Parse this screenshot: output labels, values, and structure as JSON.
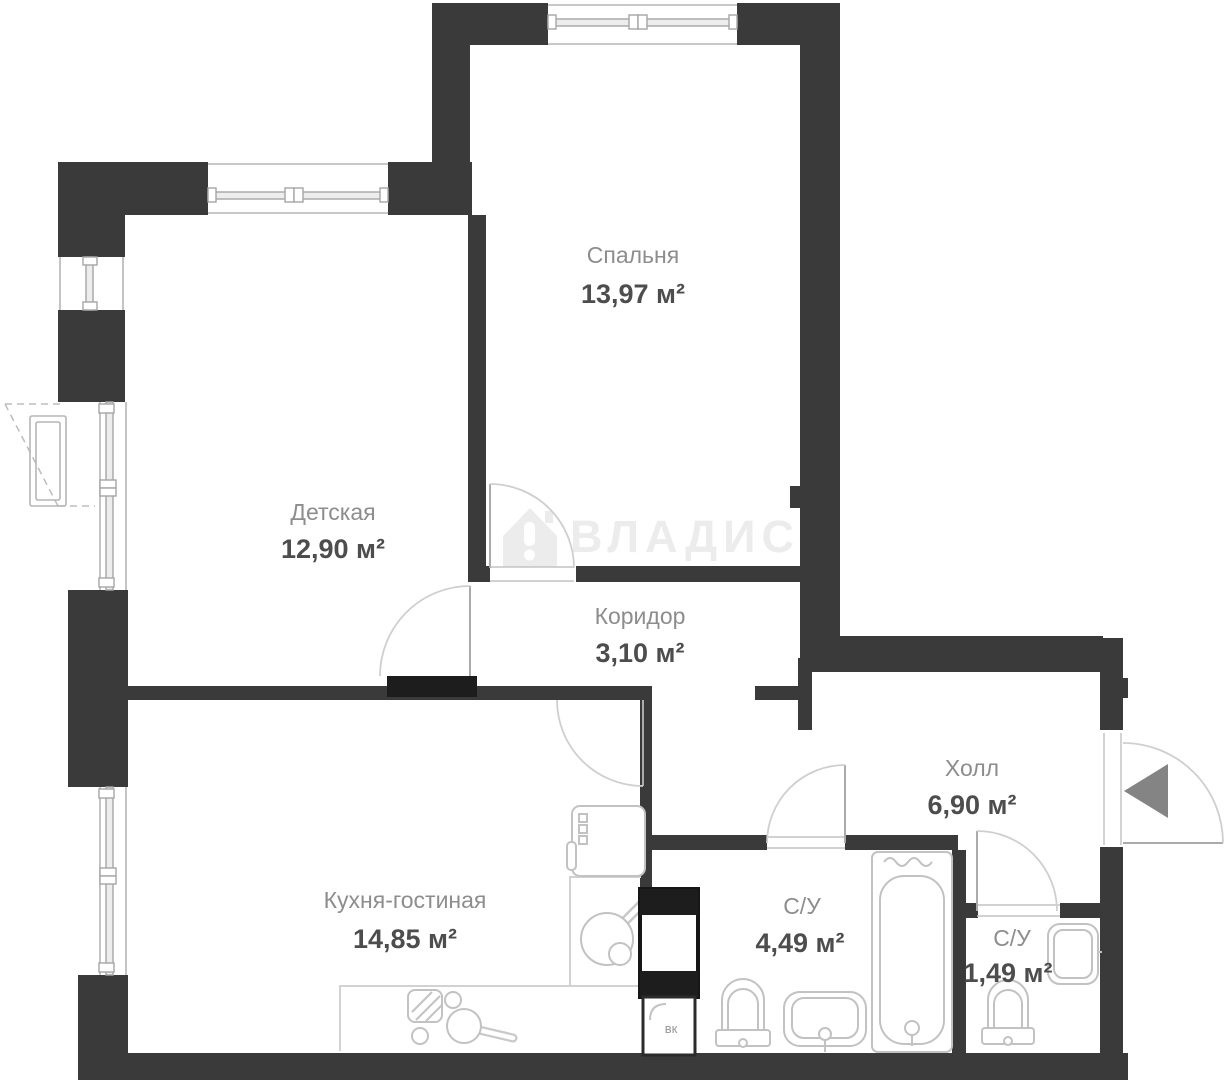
{
  "watermark": {
    "text": "ВЛАДИС"
  },
  "rooms": [
    {
      "name": "Спальня",
      "area": "13,97 м²"
    },
    {
      "name": "Детская",
      "area": "12,90 м²"
    },
    {
      "name": "Коридор",
      "area": "3,10 м²"
    },
    {
      "name": "Холл",
      "area": "6,90 м²"
    },
    {
      "name": "Кухня-гостиная",
      "area": "14,85 м²"
    },
    {
      "name": "С/У",
      "area": "4,49 м²"
    },
    {
      "name": "С/У",
      "area": "1,49 м²"
    }
  ],
  "shaft": {
    "label": "вк"
  },
  "colors": {
    "wall": "#3a3a3a",
    "threshold": "#1d1d1d",
    "fixture": "#c2c2c2",
    "door_arc": "#cfcfcf",
    "label": "#8d8d8d",
    "value": "#4d4d4d",
    "watermark": "#ececec",
    "entrance_arrow": "#848484"
  }
}
